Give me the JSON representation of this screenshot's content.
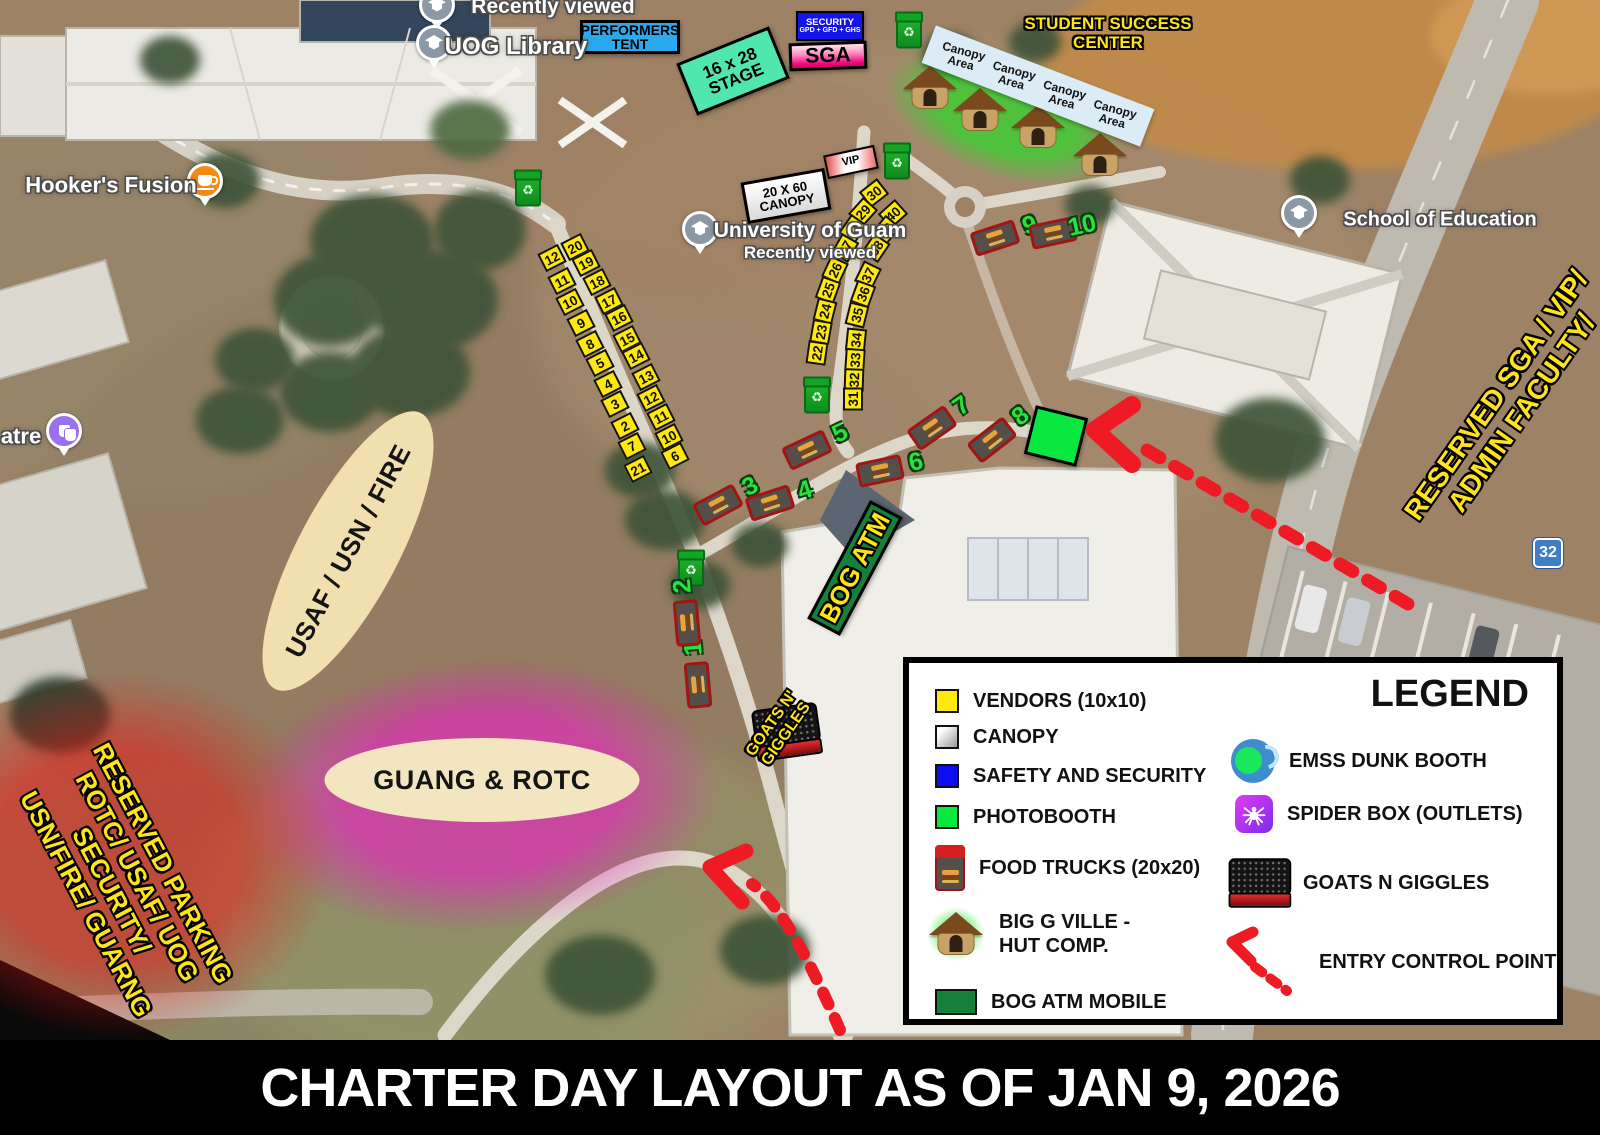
{
  "title_bar": {
    "text": "CHARTER DAY LAYOUT AS OF JAN 9, 2026"
  },
  "legend": {
    "title": "LEGEND",
    "left_items": [
      {
        "key": "vendors",
        "label": "VENDORS (10x10)"
      },
      {
        "key": "canopy",
        "label": "CANOPY"
      },
      {
        "key": "safety",
        "label": "SAFETY AND SECURITY"
      },
      {
        "key": "photobooth",
        "label": "PHOTOBOOTH"
      },
      {
        "key": "food_trucks",
        "label": "FOOD TRUCKS (20x20)"
      },
      {
        "key": "hut",
        "lines": [
          "BIG G VILLE -",
          "HUT COMP."
        ]
      },
      {
        "key": "bog_atm",
        "label": "BOG ATM MOBILE"
      }
    ],
    "right_items": [
      {
        "key": "dunk",
        "label": "EMSS DUNK BOOTH"
      },
      {
        "key": "spider",
        "label": "SPIDER BOX (OUTLETS)"
      },
      {
        "key": "goats",
        "label": "GOATS N GIGGLES"
      },
      {
        "key": "entry",
        "label": "ENTRY CONTROL POINT"
      }
    ]
  },
  "colors": {
    "vendor_yellow": "#ffe80e",
    "safety_blue": "#1414e6",
    "photobooth_green": "#08e83e",
    "bog_atm_green": "#15813a",
    "arrow_red": "#ee1b24",
    "truck_number_green": "#2ae23b",
    "label_yellow": "#ffe41c",
    "stage_teal": "#4fe7ae",
    "tent_blue": "#2aa9ef"
  },
  "map": {
    "glows": [
      {
        "id": "hut-area-glow",
        "x": 1005,
        "y": 115,
        "w": 320,
        "h": 160,
        "r": 18,
        "color": "rgba(35,224,35,0.65)"
      },
      {
        "id": "guang-glow",
        "x": 480,
        "y": 795,
        "w": 620,
        "h": 350,
        "r": -4,
        "color": "rgba(246,14,205,0.55)"
      },
      {
        "id": "parking-glow",
        "x": 118,
        "y": 855,
        "w": 560,
        "h": 470,
        "r": 0,
        "color": "rgba(240,18,18,0.5)"
      }
    ],
    "ellipses": [
      {
        "id": "usaf-usn-fire",
        "x": 348,
        "y": 551,
        "w": 312,
        "h": 100,
        "r": -62,
        "bg": "#f2dfb0",
        "text": "USAF / USN / FIRE",
        "fs": 26
      },
      {
        "id": "guang-rotc",
        "x": 482,
        "y": 780,
        "w": 315,
        "h": 84,
        "r": 0,
        "bg": "#f2e5c0",
        "text": "GUANG & ROTC",
        "fs": 27
      }
    ],
    "boxes": [
      {
        "id": "performers-tent",
        "x": 630,
        "y": 37,
        "w": 100,
        "h": 34,
        "r": 0,
        "bg": "#2aa9ef",
        "lines": [
          "PERFORMERS",
          "TENT"
        ],
        "fs": 14,
        "color": "#000"
      },
      {
        "id": "stage-16x28",
        "x": 733,
        "y": 71,
        "w": 100,
        "h": 56,
        "r": -22,
        "bg": "#4fe7ae",
        "lines": [
          "16 x 28",
          "STAGE"
        ],
        "fs": 17,
        "color": "#000"
      },
      {
        "id": "security-gpd-gfd-ghs",
        "x": 830,
        "y": 26,
        "w": 68,
        "h": 30,
        "r": 0,
        "bw": 2,
        "bg": "#1414e6",
        "lines": [
          "SECURITY",
          "GPD + GFD + GHS"
        ],
        "fs": 9.5,
        "fs2": 7,
        "color": "#fff"
      },
      {
        "id": "sga",
        "x": 828,
        "y": 56,
        "w": 78,
        "h": 28,
        "r": -2,
        "bg": "linear-gradient(180deg,#ffe3ef 0%,#ff8fc0 40%,#f00f85 80%,#d8005f 100%)",
        "lines": [
          "SGA"
        ],
        "fs": 21,
        "color": "#000"
      },
      {
        "id": "canopy-20x60",
        "x": 786,
        "y": 196,
        "w": 85,
        "h": 42,
        "r": -10,
        "bg": "linear-gradient(180deg,#ffffff,#d9d9d9)",
        "lines": [
          "20 X 60",
          "CANOPY"
        ],
        "fs": 13,
        "color": "#000"
      },
      {
        "id": "vip",
        "x": 851,
        "y": 162,
        "w": 52,
        "h": 24,
        "r": -12,
        "bw": 2,
        "bg": "linear-gradient(100deg,#e04848 0%,#ffffff 38%,#ffffff 62%,#eb6a6a 100%)",
        "lines": [
          "VIP"
        ],
        "fs": 11,
        "color": "#000"
      },
      {
        "id": "bog-atm",
        "x": 855,
        "y": 568,
        "w": 134,
        "h": 37,
        "r": -62,
        "bg": "#15813a",
        "lines": [
          "BOG ATM"
        ],
        "fs": 26,
        "color": "#ffe41c",
        "outline": true
      },
      {
        "id": "photobooth-square",
        "x": 1056,
        "y": 436,
        "w": 54,
        "h": 50,
        "r": 14,
        "bg": "#08e83e",
        "lines": [],
        "fs": 0
      }
    ],
    "canopy_strip": {
      "id": "canopy-area-strip",
      "x": 1038,
      "y": 86,
      "w": 234,
      "h": 40,
      "r": 21,
      "bg": "#dcecf7",
      "fs": 12,
      "labels": [
        "Canopy Area",
        "Canopy Area",
        "Canopy Area",
        "Canopy Area"
      ]
    },
    "big_texts": [
      {
        "id": "student-success-center",
        "x": 1108,
        "y": 33,
        "r": 0,
        "fs": 17,
        "lines": [
          "STUDENT SUCCESS",
          "CENTER"
        ]
      },
      {
        "id": "reserved-sga-vip",
        "x": 1509,
        "y": 404,
        "r": -55,
        "fs": 28,
        "lines": [
          "RESERVED SGA / VIP/",
          "ADMIN FACULTY/"
        ]
      },
      {
        "id": "reserved-parking",
        "x": 124,
        "y": 884,
        "r": 62,
        "fs": 26,
        "lines": [
          "RESERVED PARKING",
          "ROTC/ USAF/ UOG",
          "SECURITY/",
          "USN/FIRE/ GUARNG"
        ]
      },
      {
        "id": "goats-giggles-label",
        "x": 779,
        "y": 729,
        "r": -55,
        "fs": 16,
        "lines": [
          "GOATS N'",
          "GIGGLES"
        ]
      }
    ],
    "place_labels": [
      {
        "id": "recently-viewed-top",
        "x": 553,
        "y": 7,
        "fs": 21,
        "lines": [
          "Recently viewed"
        ],
        "pin": {
          "x": 437,
          "y": 8,
          "color": "#8b99a6",
          "icon": "school"
        }
      },
      {
        "id": "uog-library",
        "x": 516,
        "y": 47,
        "fs": 24,
        "lines": [
          "UOG Library"
        ],
        "pin": {
          "x": 434,
          "y": 46,
          "color": "#8b99a6",
          "icon": "school"
        }
      },
      {
        "id": "hookers-fusion",
        "x": 111,
        "y": 185,
        "fs": 22,
        "lines": [
          "Hooker's Fusion"
        ],
        "pin": {
          "x": 205,
          "y": 184,
          "color": "#f18b17",
          "icon": "cafe"
        }
      },
      {
        "id": "theatre-partial",
        "x": 21,
        "y": 436,
        "fs": 22,
        "lines": [
          "atre"
        ],
        "pin": {
          "x": 64,
          "y": 434,
          "color": "#9a70ee",
          "icon": "theater"
        }
      },
      {
        "id": "university-of-guam",
        "x": 810,
        "y": 241,
        "fs": 21,
        "fs2": 17,
        "lines": [
          "University of Guam",
          "Recently viewed"
        ],
        "pin": {
          "x": 700,
          "y": 232,
          "color": "#8b99a6",
          "icon": "school"
        }
      },
      {
        "id": "school-of-education",
        "x": 1440,
        "y": 220,
        "fs": 20,
        "lines": [
          "School of Education"
        ],
        "pin": {
          "x": 1299,
          "y": 216,
          "color": "#8b99a6",
          "icon": "school"
        }
      }
    ],
    "route_badge": {
      "id": "route-32",
      "x": 1548,
      "y": 553,
      "text": "32"
    },
    "vendors": [
      [
        "12",
        552,
        258,
        -27
      ],
      [
        "20",
        575,
        247,
        -27
      ],
      [
        "11",
        562,
        281,
        -27
      ],
      [
        "19",
        586,
        263,
        -27
      ],
      [
        "10",
        570,
        302,
        -27
      ],
      [
        "18",
        597,
        282,
        -27
      ],
      [
        "9",
        581,
        323,
        -27
      ],
      [
        "17",
        609,
        301,
        -27
      ],
      [
        "8",
        590,
        344,
        -27
      ],
      [
        "16",
        619,
        318,
        -27
      ],
      [
        "5",
        600,
        363,
        -27
      ],
      [
        "15",
        627,
        339,
        -27
      ],
      [
        "4",
        608,
        384,
        -27
      ],
      [
        "14",
        636,
        356,
        -27
      ],
      [
        "3",
        615,
        404,
        -27
      ],
      [
        "13",
        646,
        377,
        -27
      ],
      [
        "2",
        625,
        426,
        -27
      ],
      [
        "12",
        651,
        398,
        -27
      ],
      [
        "7",
        632,
        446,
        -27
      ],
      [
        "11",
        661,
        417,
        -27
      ],
      [
        "21",
        638,
        469,
        -27
      ],
      [
        "10",
        669,
        437,
        -27
      ],
      [
        "6",
        675,
        456,
        -27
      ],
      [
        "30",
        874,
        193,
        -38
      ],
      [
        "40",
        893,
        214,
        -42
      ],
      [
        "29",
        863,
        212,
        -48
      ],
      [
        "39",
        886,
        230,
        -50
      ],
      [
        "28",
        853,
        229,
        -55
      ],
      [
        "38",
        876,
        248,
        -56
      ],
      [
        "27",
        845,
        248,
        -60
      ],
      [
        "37",
        868,
        275,
        -64
      ],
      [
        "26",
        835,
        270,
        -65
      ],
      [
        "36",
        863,
        294,
        -70
      ],
      [
        "25",
        828,
        290,
        -70
      ],
      [
        "35",
        857,
        315,
        -76
      ],
      [
        "24",
        825,
        311,
        -76
      ],
      [
        "34",
        856,
        340,
        -84
      ],
      [
        "23",
        821,
        332,
        -80
      ],
      [
        "33",
        855,
        360,
        -86
      ],
      [
        "22",
        817,
        353,
        -82
      ],
      [
        "32",
        854,
        380,
        -88
      ],
      [
        "31",
        853,
        399,
        -90
      ]
    ],
    "food_trucks": [
      [
        "1",
        698,
        685,
        -95
      ],
      [
        "2",
        687,
        623,
        -95
      ],
      [
        "3",
        718,
        505,
        -28
      ],
      [
        "4",
        770,
        503,
        -18
      ],
      [
        "5",
        807,
        450,
        -25
      ],
      [
        "6",
        880,
        471,
        -12
      ],
      [
        "7",
        932,
        428,
        -35
      ],
      [
        "8",
        992,
        440,
        -38
      ],
      [
        "9",
        995,
        238,
        -18
      ],
      [
        "10",
        1053,
        233,
        -12
      ]
    ],
    "trash_bins": [
      [
        909,
        32
      ],
      [
        897,
        163
      ],
      [
        528,
        190
      ],
      [
        817,
        397
      ],
      [
        691,
        570
      ]
    ],
    "huts": [
      [
        930,
        88
      ],
      [
        980,
        110
      ],
      [
        1038,
        127
      ],
      [
        1100,
        155
      ]
    ]
  }
}
